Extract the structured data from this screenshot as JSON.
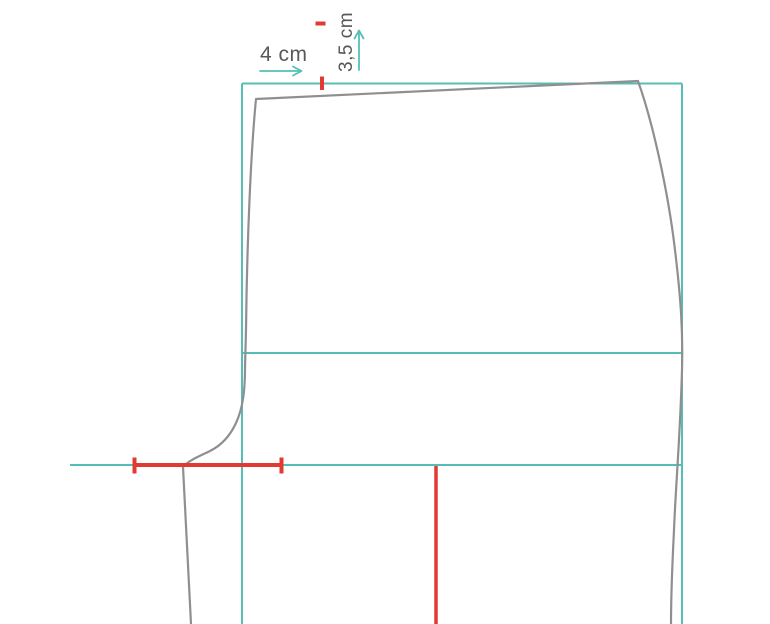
{
  "labels": {
    "horizontal_measure": "4 cm",
    "vertical_measure": "3,5 cm"
  },
  "icons": {
    "horizontal_arrow": "arrow-right",
    "vertical_arrow": "arrow-up"
  },
  "colors": {
    "background": "#ffffff",
    "construction_line": "#55bfb7",
    "marking": "#e23a31",
    "pattern_outline": "#8f8f8f",
    "label_text": "#58585b"
  }
}
